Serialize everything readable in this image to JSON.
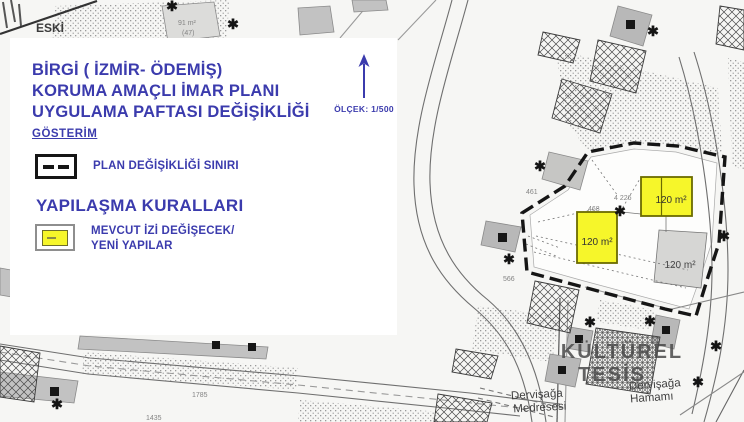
{
  "panel": {
    "title_line1": "BİRGİ ( İZMİR- ÖDEMİŞ)",
    "title_line2": "KORUMA AMAÇLI İMAR PLANI",
    "title_line3": "UYGULAMA PAFTASI DEĞİŞİKLİĞİ",
    "legend_header": "GÖSTERİM",
    "boundary_label": "PLAN DEĞİŞİKLİĞİ SINIRI",
    "rules_header": "YAPILAŞMA KURALLARI",
    "new_buildings_label_line1": "MEVCUT İZİ DEĞİŞECEK/",
    "new_buildings_label_line2": "YENİ YAPILAR",
    "scale_label": "ÖLÇEK: 1/500"
  },
  "map": {
    "star_glyph": "✱",
    "labels": {
      "eski": "ESKİ",
      "parcel_91": "91 m²",
      "parcel_47": "(47)",
      "parcel_461": "461",
      "parcel_468": "468",
      "parcel_4226": "4 226",
      "parcel_566": "566",
      "parcel_1435": "1435",
      "parcel_1785": "1785",
      "yellow_building_1_area": "120 m²",
      "yellow_building_2_area": "120 m²",
      "gray_parcel_area": "120 m²",
      "kulturel_line1": "KÜLTÜREL",
      "kulturel_line2": "TESİS",
      "medrese_line1": "Dervişağa",
      "medrese_line2": "Medresesi",
      "hamam_line1": "Dervişağa",
      "hamam_line2": "Hamamı"
    }
  },
  "colors": {
    "title_blue": "#3b3bad",
    "highlight_yellow": "#f6f62a",
    "boundary_black": "#151515",
    "building_gray": "#c2c2c2"
  }
}
